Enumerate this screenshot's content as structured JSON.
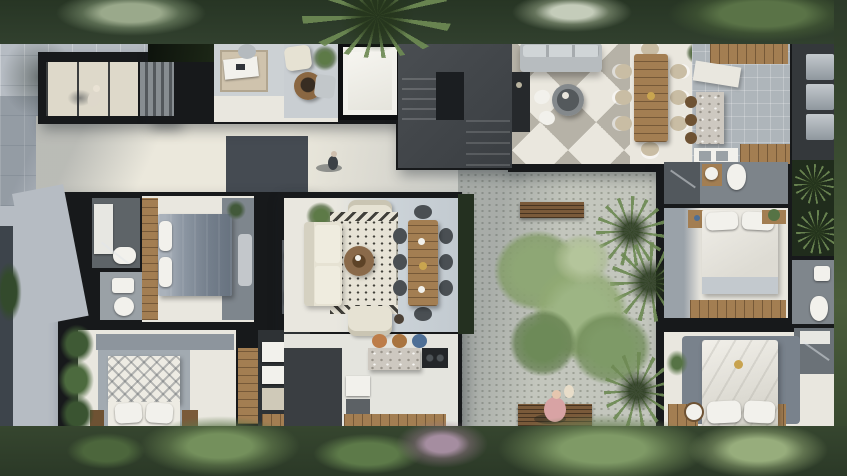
{
  "image": {
    "kind": "top-down architectural floor plan render",
    "width_px": 847,
    "height_px": 476,
    "description": "Aerial cutaway render of a modern single-family villa with rooftop terrace, central courtyard tree, four bedrooms, open living-dining-kitchen, surrounded by tropical vegetation and a gray paved driveway"
  },
  "palette": {
    "pavement": "#b6bcc3",
    "pavement-dark": "#4d545b",
    "cream": "#ded9ca",
    "cream-bright": "#ebe8dc",
    "wall": "#17191b",
    "roof": "#43474b",
    "roof-dark": "#1b1e21",
    "glass": "#10150e",
    "floor-white": "#e9e7df",
    "floor-dark": "#5e6468",
    "tile-gray": "#aeb5ba",
    "wood": "#a37e52",
    "wood-dark": "#6e5233",
    "terrazzo": "#cdc8c0",
    "cream-sofa": "#e6e2d3",
    "bed-gray": "#7d8793",
    "bed-white": "#edebe3",
    "slate": "#79828b",
    "appliance": "#99a1a8",
    "bench-wood": "#7a5a3a",
    "pink": "#d8a3a4",
    "checker-gray": "#b6b2a7",
    "checker-white": "#eae7de",
    "rug": "#e7e3d6",
    "gravel": "#c3c6bd",
    "white": "#f2f1ec",
    "chair-tan": "#c9bda4",
    "stool-orange": "#bd7d49",
    "stool-blue": "#4e6f96",
    "veg-dark": "#2b382a",
    "veg-mid": "#49603c",
    "veg-light": "#83a068"
  },
  "scene": {
    "rooms": {
      "driveway": "Driveway",
      "entry": "Entry walkway canopy",
      "stairs": "Staircase",
      "studio": "Studio / office nook",
      "lounge": "Rooftop lounge",
      "skylight": "Skylight",
      "deck": "Roof deck",
      "terrace": "Terrace lounge",
      "outdoorDining": "Outdoor dining terrace",
      "outdoorKitchen": "Outdoor kitchen",
      "utility": "Utility room",
      "bath1": "Bathroom",
      "bedroom1": "Bedroom",
      "powder": "Powder room",
      "bedroom2": "Bedroom",
      "closet": "Walk-in closet",
      "living": "Living room",
      "dining": "Indoor dining",
      "kitchen": "Kitchen",
      "courtyard": "Central courtyard",
      "bath2": "Bathroom",
      "bedroom3": "Bedroom",
      "bath3": "Bathroom",
      "master": "Master bedroom",
      "masterShower": "Master shower"
    },
    "furniture": [
      "desk with chair",
      "fire pit",
      "outdoor sofa",
      "round coffee table",
      "8-seat wooden dining table",
      "kitchen island with stools",
      "appliance column",
      "double bed with gray duvet",
      "double bed with patterned duvet",
      "white double bed",
      "master bed with round side table",
      "cream sofa set",
      "patterned rug",
      "indoor dining table",
      "terrazzo island with cooktop",
      "wardrobe shelving",
      "toilets and washbasins",
      "wooden benches"
    ],
    "landscape": [
      "perimeter tropical trees",
      "central courtyard tree",
      "palm clusters",
      "planting bed strips",
      "gravel courtyard",
      "lawn reflection glass roof"
    ],
    "people": [
      "person walking under entry canopy",
      "person walking on patio",
      "person seated on courtyard bench"
    ]
  }
}
